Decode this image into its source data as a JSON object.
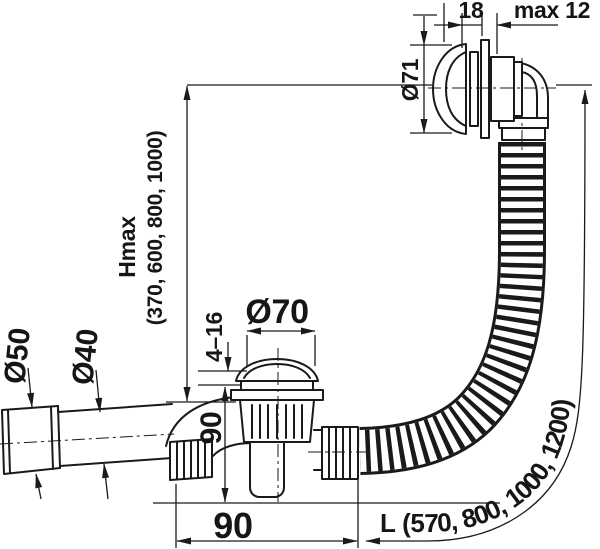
{
  "colors": {
    "line": "#1a1a1a",
    "background": "#ffffff"
  },
  "dims": {
    "overflow_grip": "18",
    "overflow_wall_max": "max 12",
    "overflow_diameter": "Ø71",
    "height_label": "Hmax",
    "height_values": "(370, 600, 800, 1000)",
    "plug_diameter": "Ø70",
    "clamp_range": "4–16",
    "waste_height": "90",
    "waste_offset": "90",
    "outlet_sleeve_diameter": "Ø50",
    "outlet_pipe_diameter": "Ø40",
    "hose_length": "L (570, 800, 1000, 1200)"
  }
}
